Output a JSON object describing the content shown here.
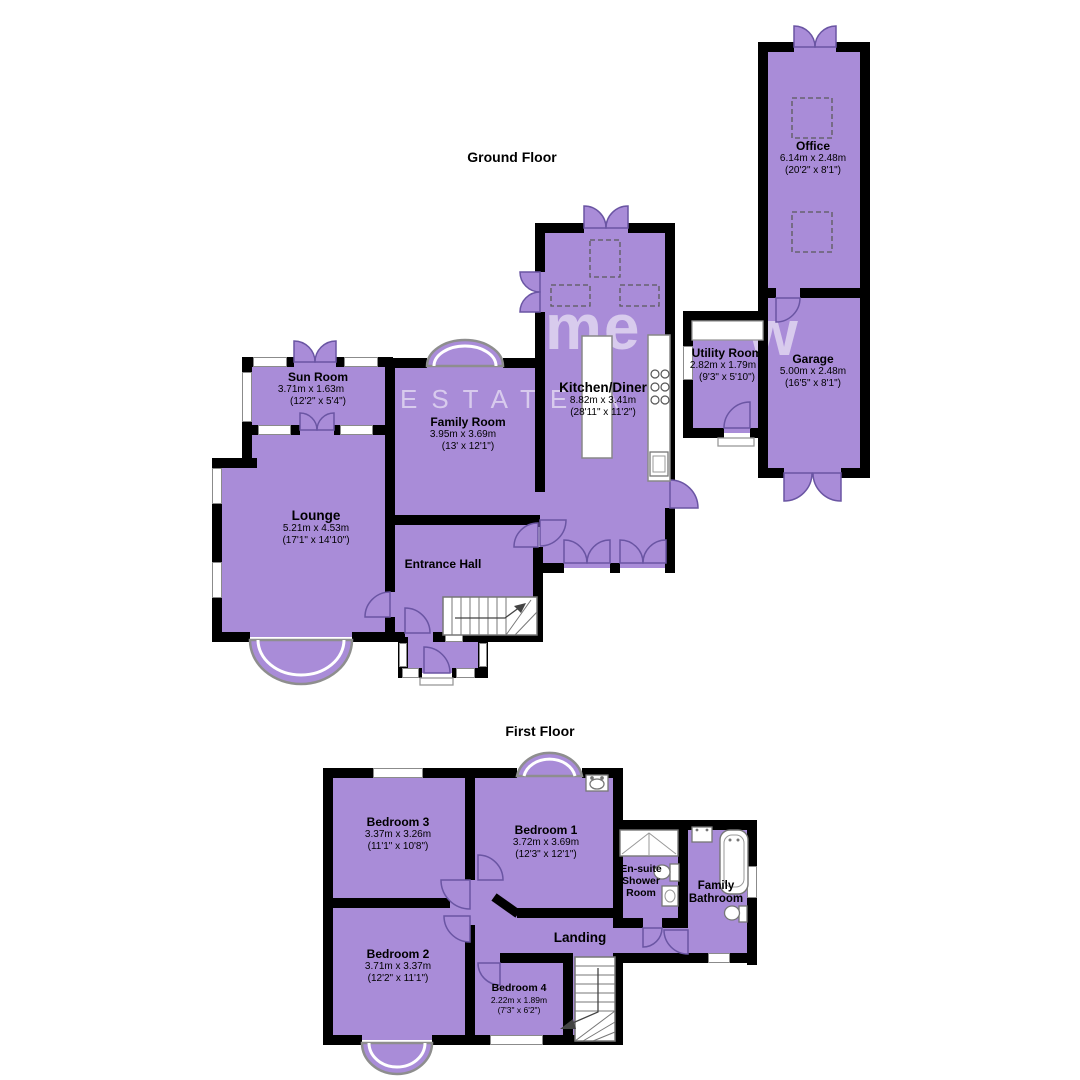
{
  "colors": {
    "room_fill": "#a98cd8",
    "wall": "#000000",
    "window_border": "#8b8b8b",
    "door_stroke": "#6a55a3",
    "watermark": "rgba(255,255,255,0.55)"
  },
  "floors": [
    {
      "title": "Ground Floor",
      "rooms": [
        {
          "name": "Office",
          "metric": "6.14m x 2.48m",
          "imperial": "(20'2\" x 8'1\")"
        },
        {
          "name": "Garage",
          "metric": "5.00m x 2.48m",
          "imperial": "(16'5\" x 8'1\")"
        },
        {
          "name": "Utility Room",
          "metric": "2.82m x 1.79m",
          "imperial": "(9'3\" x 5'10\")"
        },
        {
          "name": "Kitchen/Diner",
          "metric": "8.82m x 3.41m",
          "imperial": "(28'11\" x 11'2\")"
        },
        {
          "name": "Family Room",
          "metric": "3.95m x 3.69m",
          "imperial": "(13' x 12'1\")"
        },
        {
          "name": "Sun Room",
          "metric": "3.71m x 1.63m",
          "imperial": "(12'2\" x 5'4\")"
        },
        {
          "name": "Lounge",
          "metric": "5.21m x 4.53m",
          "imperial": "(17'1\" x 14'10\")"
        },
        {
          "name": "Entrance Hall",
          "metric": "",
          "imperial": ""
        }
      ]
    },
    {
      "title": "First Floor",
      "rooms": [
        {
          "name": "Bedroom 3",
          "metric": "3.37m x 3.26m",
          "imperial": "(11'1\" x 10'8\")"
        },
        {
          "name": "Bedroom 1",
          "metric": "3.72m x 3.69m",
          "imperial": "(12'3\" x 12'1\")"
        },
        {
          "name": "En-suite Shower Room",
          "metric": "",
          "imperial": ""
        },
        {
          "name": "Family Bathroom",
          "metric": "",
          "imperial": ""
        },
        {
          "name": "Landing",
          "metric": "",
          "imperial": ""
        },
        {
          "name": "Bedroom 2",
          "metric": "3.71m x 3.37m",
          "imperial": "(12'2\" x 11'1\")"
        },
        {
          "name": "Bedroom 4",
          "metric": "2.22m x 1.89m",
          "imperial": "(7'3\" x 6'2\")"
        }
      ]
    }
  ],
  "watermark": {
    "word1": "me",
    "word2": "w",
    "line": "ESTATE A"
  }
}
